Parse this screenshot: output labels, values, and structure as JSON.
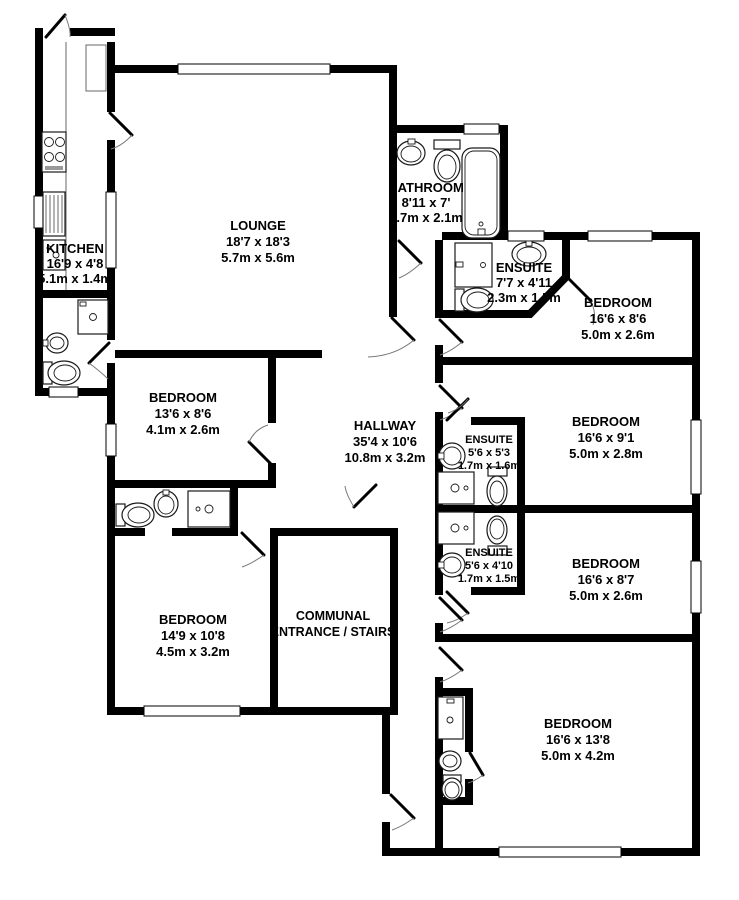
{
  "plan": {
    "type": "floorplan",
    "colors": {
      "wall": "#000000",
      "background": "#ffffff",
      "fixture_line": "#1a1a1a"
    },
    "rooms": {
      "kitchen": {
        "name": "KITCHEN",
        "imperial": "16'9 x 4'8",
        "metric": "5.1m x 1.4m"
      },
      "lounge": {
        "name": "LOUNGE",
        "imperial": "18'7 x 18'3",
        "metric": "5.7m x 5.6m"
      },
      "bathroom": {
        "name": "BATHROOM",
        "imperial": "8'11 x 7'",
        "metric": "2.7m x 2.1m"
      },
      "ensuite_top": {
        "name": "ENSUITE",
        "imperial": "7'7 x 4'11",
        "metric": "2.3m x 1.5m"
      },
      "bedroom_top_right": {
        "name": "BEDROOM",
        "imperial": "16'6 x 8'6",
        "metric": "5.0m x 2.6m"
      },
      "bedroom_left": {
        "name": "BEDROOM",
        "imperial": "13'6 x 8'6",
        "metric": "4.1m x 2.6m"
      },
      "hallway": {
        "name": "HALLWAY",
        "imperial": "35'4 x 10'6",
        "metric": "10.8m x 3.2m"
      },
      "ensuite_mid_upper": {
        "name": "ENSUITE",
        "imperial": "5'6 x 5'3",
        "metric": "1.7m x 1.6m"
      },
      "bedroom_right_mid": {
        "name": "BEDROOM",
        "imperial": "16'6 x 9'1",
        "metric": "5.0m x 2.8m"
      },
      "ensuite_mid_lower": {
        "name": "ENSUITE",
        "imperial": "5'6 x 4'10",
        "metric": "1.7m x 1.5m"
      },
      "bedroom_right_low": {
        "name": "BEDROOM",
        "imperial": "16'6 x 8'7",
        "metric": "5.0m x 2.6m"
      },
      "bedroom_bot_left": {
        "name": "BEDROOM",
        "imperial": "14'9 x 10'8",
        "metric": "4.5m x 3.2m"
      },
      "communal": {
        "line1": "COMMUNAL",
        "line2": "ENTRANCE / STAIRS"
      },
      "bedroom_bottom": {
        "name": "BEDROOM",
        "imperial": "16'6 x 13'8",
        "metric": "5.0m x 4.2m"
      }
    }
  }
}
